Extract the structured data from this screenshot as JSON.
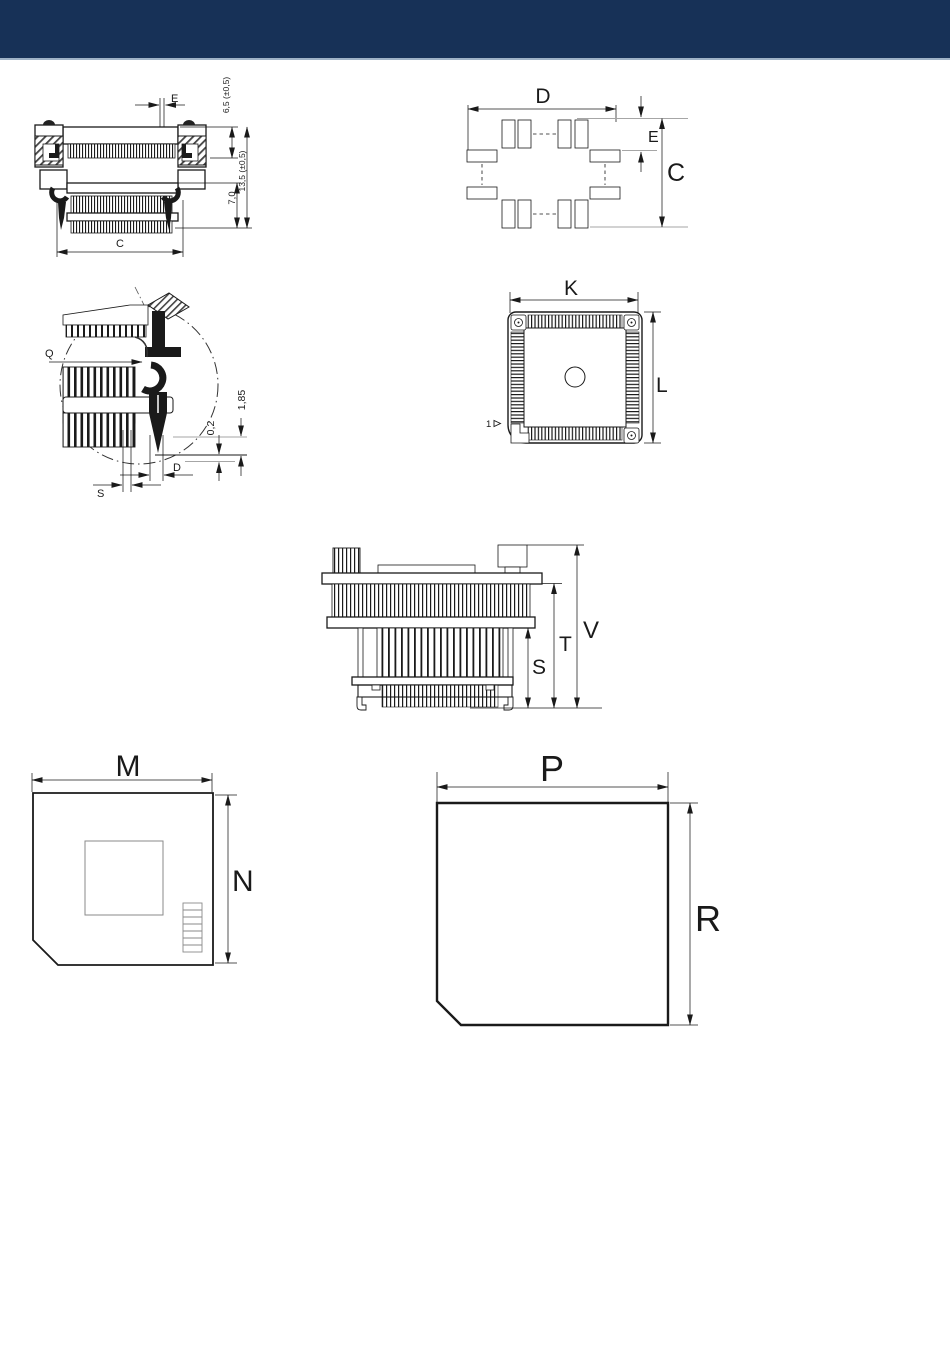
{
  "header": {
    "bar_color": "#173157",
    "underline_color": "#9fb2c6"
  },
  "drawings": {
    "cross_section": {
      "dims": {
        "pin_pitch": "E",
        "upper_height": "6,5 (±0,5)",
        "total_height": "13,5 (±0,5)",
        "lower_height": "7,0",
        "body_width": "C"
      }
    },
    "footprint": {
      "dims": {
        "pattern_width": "D",
        "pad_offset": "E",
        "pattern_height": "C"
      }
    },
    "contact_detail": {
      "dims": {
        "q_ref": "Q",
        "standoff": "1,85",
        "clearance": "0,2",
        "pin_width": "D",
        "pin_thickness": "S"
      }
    },
    "top_view": {
      "dims": {
        "body_width": "K",
        "body_height": "L"
      },
      "pin1_label": "1"
    },
    "side_view": {
      "dims": {
        "total_height": "V",
        "middle_height": "T",
        "lower_height": "S"
      }
    },
    "pallet_top": {
      "dims": {
        "width": "M",
        "height": "N"
      }
    },
    "pallet_bottom": {
      "dims": {
        "width": "P",
        "height": "R"
      }
    }
  }
}
